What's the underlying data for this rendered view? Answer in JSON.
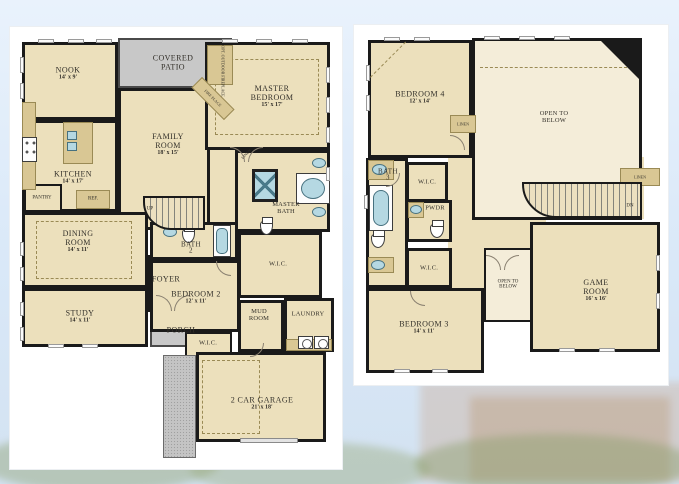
{
  "colors": {
    "background_sky": "#dce9f8",
    "panel_white": "#ffffff",
    "room_fill": "#ece0bc",
    "open_to_below_fill": "#f4edd9",
    "wall_black": "#1a1a1a",
    "patio_gray": "#c8c8c8",
    "fixture_blue": "#b5d8e2",
    "cabinet_tan": "#d9c794"
  },
  "floor1": {
    "nook": {
      "name": "NOOK",
      "dims": "14' x 9'"
    },
    "covered_patio": {
      "name": "COVERED PATIO"
    },
    "opt_outdoor_fireplace": {
      "name": "OPT. OUTDOOR FIREPLACE"
    },
    "fireplace": {
      "name": "FIRE PLACE"
    },
    "master_bedroom": {
      "name": "MASTER BEDROOM",
      "dims": "15' x 17'"
    },
    "family_room": {
      "name": "FAMILY ROOM",
      "dims": "18' x 15'"
    },
    "kitchen": {
      "name": "KITCHEN",
      "dims": "14' x 17'"
    },
    "pantry": {
      "name": "PANTRY"
    },
    "ref": {
      "name": "REF."
    },
    "dining_room": {
      "name": "DINING ROOM",
      "dims": "14' x 11'"
    },
    "study": {
      "name": "STUDY",
      "dims": "14' x 11'"
    },
    "foyer": {
      "name": "FOYER"
    },
    "porch": {
      "name": "PORCH"
    },
    "stairs": {
      "name": "UP"
    },
    "bath2": {
      "name": "BATH",
      "num": "2"
    },
    "bedroom2": {
      "name": "BEDROOM 2",
      "dims": "12' x 11'"
    },
    "wic_bedroom2": {
      "name": "W.I.C."
    },
    "mud_room": {
      "name": "MUD ROOM"
    },
    "laundry": {
      "name": "LAUNDRY"
    },
    "master_bath": {
      "name": "MASTER BATH"
    },
    "linen": {
      "name": "LINEN"
    },
    "master_wic": {
      "name": "W.I.C."
    },
    "garage": {
      "name": "2 CAR GARAGE",
      "dims": "21' x 18'"
    }
  },
  "floor2": {
    "bedroom4": {
      "name": "BEDROOM 4",
      "dims": "12' x 14'"
    },
    "open_to_below_main": {
      "name": "OPEN TO BELOW"
    },
    "linen_hall": {
      "name": "LINEN"
    },
    "bath3": {
      "name": "BATH",
      "num": "3"
    },
    "wic_bedroom4": {
      "name": "W.I.C."
    },
    "pwdr": {
      "name": "PWDR"
    },
    "wic_bedroom3": {
      "name": "W.I.C."
    },
    "bedroom3": {
      "name": "BEDROOM 3",
      "dims": "14' x 11'"
    },
    "open_to_below_small": {
      "name": "OPEN TO BELOW"
    },
    "game_room": {
      "name": "GAME ROOM",
      "dims": "16' x 16'"
    },
    "linen_stairs": {
      "name": "LINEN"
    },
    "stairs": {
      "name": "DN"
    }
  }
}
